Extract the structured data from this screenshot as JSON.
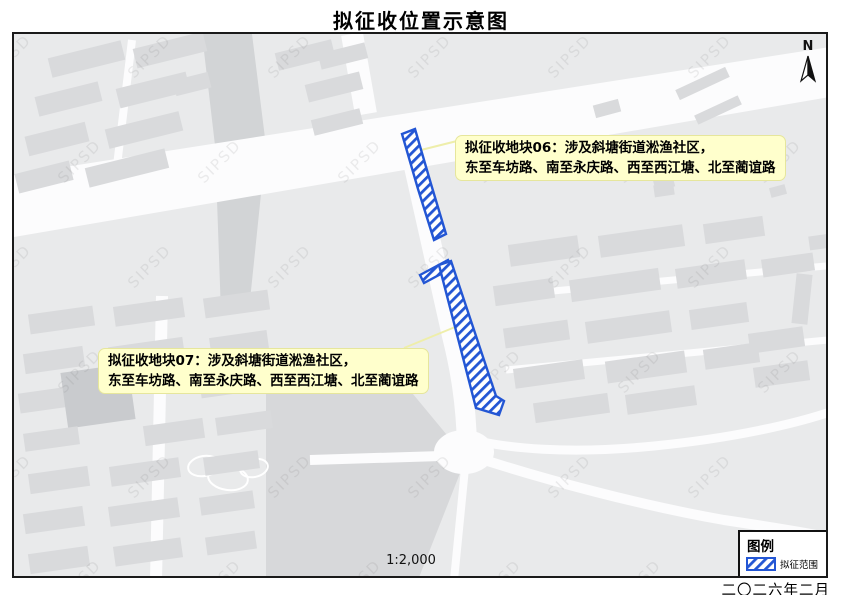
{
  "title": "拟征收位置示意图",
  "map": {
    "watermark_text": "SIPSD",
    "north_label": "N",
    "scale_text": "1:2,000",
    "annotation_06": {
      "line1": "拟征收地块06：涉及斜塘街道淞渔社区，",
      "line2": "东至车坊路、南至永庆路、西至西江塘、北至蔺谊路"
    },
    "annotation_07": {
      "line1": "拟征收地块07：涉及斜塘街道淞渔社区，",
      "line2": "东至车坊路、南至永庆路、西至西江塘、北至蔺谊路"
    }
  },
  "legend": {
    "title": "图例",
    "items": [
      {
        "label": "拟征范围",
        "symbol": "blue-diagonal-hatch"
      }
    ]
  },
  "footer": {
    "date": "二〇二六年二月"
  },
  "colors": {
    "accent_blue": "#2356D4",
    "annotation_bg": "#FFFFCC",
    "map_bg": "#E9EAEB",
    "road": "#FCFCFD",
    "building": "#D9DADC"
  }
}
